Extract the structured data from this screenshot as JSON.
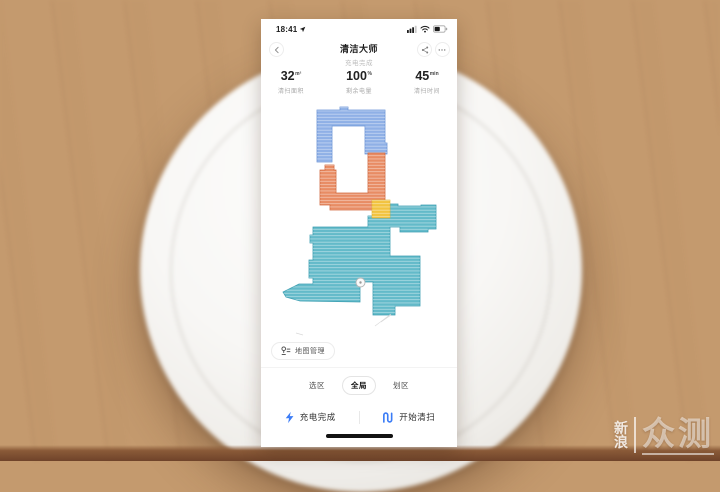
{
  "status_bar": {
    "time": "18:41"
  },
  "nav": {
    "title": "清洁大师",
    "subtitle": "充电完成"
  },
  "stats": [
    {
      "value": "32",
      "unit": "m²",
      "label": "清扫面积"
    },
    {
      "value": "100",
      "unit": "%",
      "label": "剩余电量"
    },
    {
      "value": "45",
      "unit": "min",
      "label": "清扫时间"
    }
  ],
  "map": {
    "manage_button": "地图管理",
    "colors": {
      "blue_room": "#8fb0e6",
      "blue_edge": "#6b94d6",
      "orange_room": "#e88c64",
      "orange_edge": "#d1693f",
      "yellow_junction": "#f2c33f",
      "yellow_edge": "#ddb032",
      "teal_room": "#63bac9",
      "teal_edge": "#3d9fb2"
    }
  },
  "tabs": [
    {
      "label": "选区",
      "selected": false
    },
    {
      "label": "全局",
      "selected": true
    },
    {
      "label": "划区",
      "selected": false
    }
  ],
  "actions": [
    {
      "label": "充电完成",
      "icon": "lightning-icon"
    },
    {
      "label": "开始清扫",
      "icon": "route-icon"
    }
  ],
  "accent_color": "#3b7cf6",
  "watermark": {
    "line1": "新",
    "line2": "浪",
    "main": "众测"
  },
  "icons": [
    "location-arrow-icon",
    "signal-icon",
    "wifi-icon",
    "battery-icon",
    "back-icon",
    "share-icon",
    "more-icon",
    "map-pin-icon",
    "lightning-icon",
    "route-icon",
    "robot-marker"
  ]
}
